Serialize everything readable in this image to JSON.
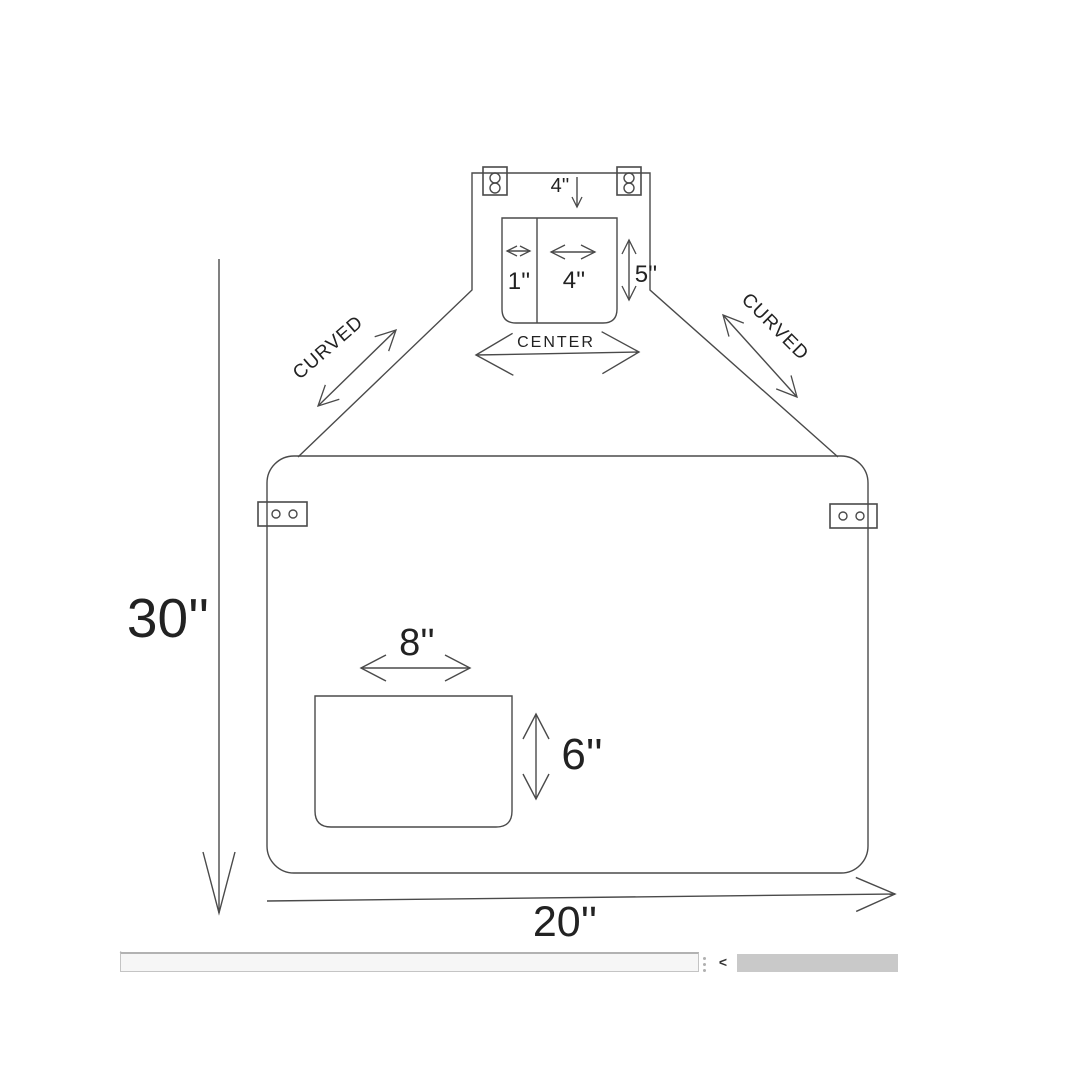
{
  "diagram": {
    "bib": {
      "top_strap_width": "4''",
      "hem_width": "1''",
      "pocket_width": "4''",
      "pocket_height": "5''",
      "center_label": "CENTER"
    },
    "straps": {
      "left_label": "CURVED",
      "right_label": "CURVED"
    },
    "body": {
      "height": "30''",
      "width": "20''",
      "pocket_width": "8''",
      "pocket_height": "6''"
    },
    "colors": {
      "line_color": "#4a4a4a",
      "text_color": "#222222"
    }
  },
  "scrollbar": {
    "prev_button_label": "<",
    "thumb_color": "#c9c9c9"
  }
}
